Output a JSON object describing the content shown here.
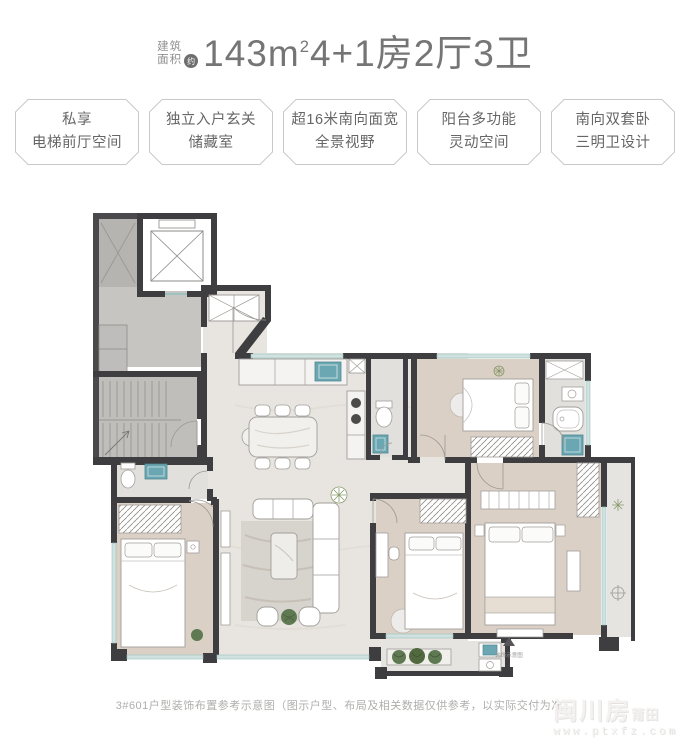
{
  "header": {
    "area_label_line1": "建筑",
    "area_label_line2": "面积",
    "approx_badge": "约",
    "title_prefix": "143m",
    "title_sup": "2",
    "title_suffix": "4+1房2厅3卫"
  },
  "badges": [
    {
      "line1": "私享",
      "line2": "电梯前厅空间"
    },
    {
      "line1": "独立入户玄关",
      "line2": "储藏室"
    },
    {
      "line1": "超16米南向面宽",
      "line2": "全景视野"
    },
    {
      "line1": "阳台多功能",
      "line2": "灵动空间"
    },
    {
      "line1": "南向双套卧",
      "line2": "三明卫设计"
    }
  ],
  "floorplan": {
    "compass_caption": "装饰示意图"
  },
  "footer": {
    "caption": "3#601户型装饰布置参考示意图（图示户型、布局及相关数据仅供参考，以实际交付为准）"
  },
  "watermark": {
    "brand": "闽川房",
    "brand_suffix": "莆田",
    "url": "www.ptxfz.com"
  },
  "colors": {
    "title_text": "#757575",
    "badge_border": "#c9c9c9",
    "badge_text": "#666666",
    "wall": "#3e3e41",
    "core_floor": "#c7c5c2",
    "apartment_floor": "#e8e5e1",
    "wood_floor": "#dbd0c5",
    "fixture_teal": "#6ba7b2",
    "window_teal": "#cfe2df",
    "plant_green": "#5f7a52",
    "caption_text": "#aeaeac"
  }
}
